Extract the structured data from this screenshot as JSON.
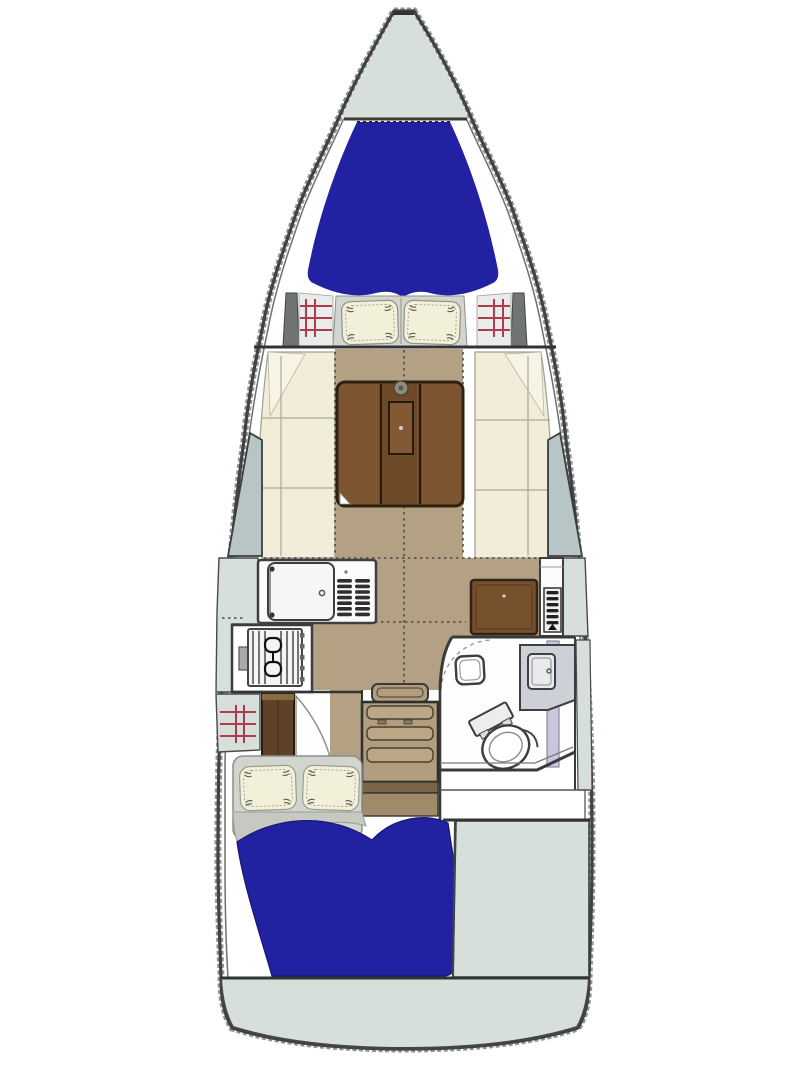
{
  "diagram": {
    "type": "sailboat-interior-floorplan",
    "orientation": "bow-at-top",
    "areas": [
      "anchor-locker",
      "v-berth-forward-cabin",
      "salon-with-folding-table",
      "port-settee",
      "starboard-settee",
      "galley-sink-icebox-stove",
      "navigation-chart-table",
      "instrument-panel",
      "head-with-toilet-sink-shower-seat",
      "companionway-steps",
      "hanging-locker",
      "aft-double-berth-cabin",
      "cockpit-area",
      "stern-transom"
    ]
  },
  "colors": {
    "paper": "#ffffff",
    "deck": "#d6dfda",
    "deck_dark": "#c3cfc9",
    "hull_stroke": "#424242",
    "hull_texture": "#8e9794",
    "inner_line": "#6f6f6f",
    "mattress_blue": "#2121a2",
    "mattress_blue_dark": "#17176e",
    "cushion_cream": "#f1edd8",
    "cushion_cream_light": "#f7f4e6",
    "cushion_edge": "#9d9f92",
    "pillow_cream": "#f3f0da",
    "bedding_gray": "#d2d5ce",
    "bedding_gray_dark": "#c6c9c2",
    "floor_tan": "#b4a183",
    "steps_tan": "#b29d7e",
    "steps_tan_light": "#bba686",
    "landing_brown": "#a08a68",
    "landing_brown_dark": "#7b6547",
    "table_brown": "#7d5531",
    "table_brown_dark": "#6e4a29",
    "table_border": "#2c2114",
    "chart_table_brown": "#77502c",
    "wardrobe_brown": "#5f4226",
    "wardrobe_top": "#8a6a42",
    "slate_panel": "#b7c5c7",
    "red_rail": "#b23a4e",
    "white_fixture": "#fbfbfa",
    "fixture_gray": "#f1f1ef",
    "head_counter": "#ccd1d8",
    "basin_gray": "#e8eaee",
    "lavender_door": "#cac6e0",
    "shelf_bg": "#e9ece8",
    "ramp_gray": "#707573",
    "slot_dark": "#2f2f2f",
    "metal_gray": "#aaaaaa"
  }
}
